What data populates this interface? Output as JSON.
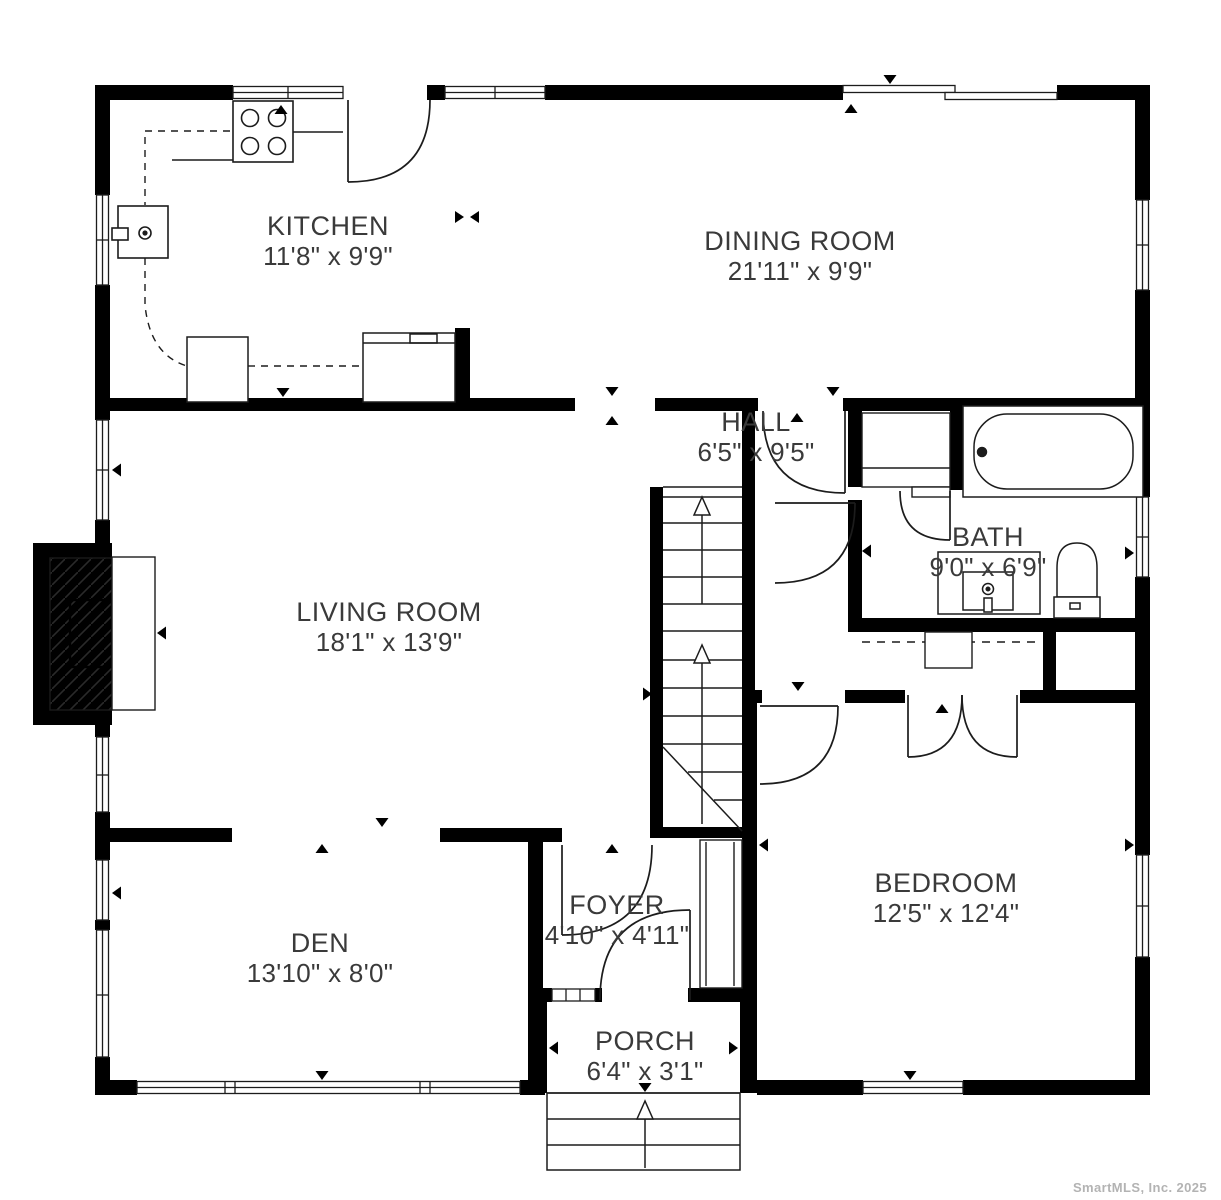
{
  "page": {
    "background": "#ffffff",
    "wall_color": "#000000",
    "line_color": "#1c1c1c",
    "text_color": "#3a3a3a",
    "watermark_color": "#b3b3b3"
  },
  "rooms": [
    {
      "id": "kitchen",
      "name": "KITCHEN",
      "dims": "11'8\" x 9'9\""
    },
    {
      "id": "dining-room",
      "name": "DINING ROOM",
      "dims": "21'11\" x 9'9\""
    },
    {
      "id": "hall",
      "name": "HALL",
      "dims": "6'5\" x 9'5\""
    },
    {
      "id": "bath",
      "name": "BATH",
      "dims": "9'0\" x 6'9\""
    },
    {
      "id": "living-room",
      "name": "LIVING ROOM",
      "dims": "18'1\" x 13'9\""
    },
    {
      "id": "den",
      "name": "DEN",
      "dims": "13'10\" x 8'0\""
    },
    {
      "id": "foyer",
      "name": "FOYER",
      "dims": "4'10\" x 4'11\""
    },
    {
      "id": "bedroom",
      "name": "BEDROOM",
      "dims": "12'5\" x 12'4\""
    },
    {
      "id": "porch",
      "name": "PORCH",
      "dims": "6'4\" x 3'1\""
    }
  ],
  "fixtures": [
    "stove-icon",
    "kitchen-sink-icon",
    "bathtub-icon",
    "toilet-icon",
    "vanity-sink-icon",
    "fireplace-icon",
    "staircase-icon",
    "closet-rod-icon",
    "porch-steps-icon",
    "door-swing-icon",
    "window-icon"
  ],
  "watermark": "SmartMLS, Inc.  2025"
}
